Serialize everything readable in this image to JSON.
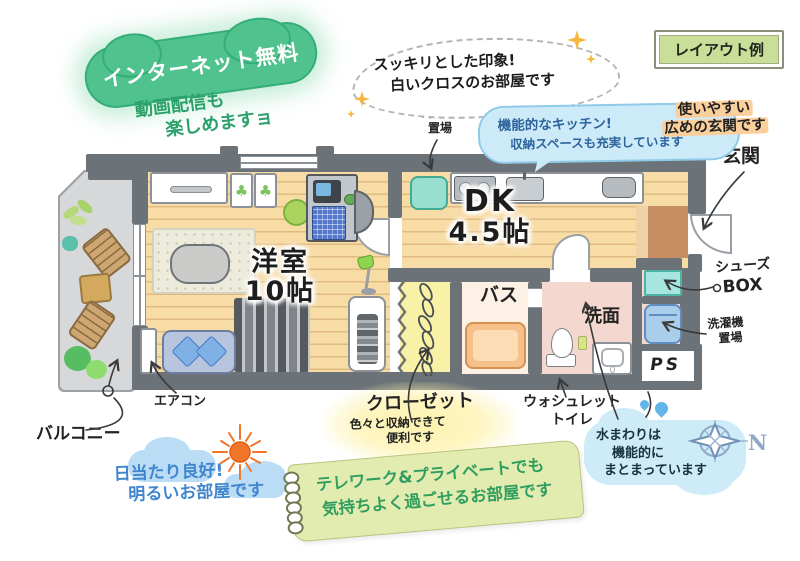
{
  "badge": "レイアウト例",
  "rooms": {
    "living_name": "洋室",
    "living_size": "10帖",
    "dk_name": "DK",
    "dk_size": "4.5帖",
    "bath": "バス",
    "washroom": "洗面",
    "entrance": "玄関",
    "balcony": "バルコニー",
    "ps": "PS"
  },
  "labels": {
    "fridge_l1": "冷蔵庫",
    "fridge_l2": "置場",
    "aircon": "エアコン",
    "shoes_l1": "シューズ",
    "shoes_l2": "BOX",
    "washer_l1": "洗濯機",
    "washer_l2": "置場",
    "toilet_l1": "ウォシュレット",
    "toilet_l2": "トイレ",
    "compass_n": "N"
  },
  "callouts": {
    "internet_title": "インターネット無料",
    "internet_sub_l1": "動画配信も",
    "internet_sub_l2": "楽しめますョ",
    "impression_l1": "スッキリとした印象!",
    "impression_l2": "白いクロスのお部屋です",
    "kitchen_l1": "機能的なキッチン!",
    "kitchen_l2": "収納スペースも充実しています",
    "entrance_l1": "使いやすい",
    "entrance_l2": "広めの玄関です",
    "closet_title": "クローゼット",
    "closet_l1": "色々と収納できて",
    "closet_l2": "便利です",
    "water_l1": "水まわりは",
    "water_l2": "機能的に",
    "water_l3": "まとまっています",
    "sun_l1": "日当たり良好!",
    "sun_l2": "明るいお部屋です",
    "telework_l1": "テレワーク&プライベートでも",
    "telework_l2": "気持ちよく過ごせるお部屋です"
  },
  "colors": {
    "wall": "#6b7378",
    "wood_floor": "#f8dca6",
    "balcony_floor": "#d7d8da",
    "entrance_floor": "#c78f63",
    "closet": "#f8f1a6",
    "bathtub": "#f5c08a",
    "washroom_floor": "#f4d8cf",
    "shoes_box": "#a7e6de",
    "washer": "#a9cdea",
    "fridge_space": "#99dfd0",
    "internet_green": "#4fc28e",
    "bubble_blue": "#cdeaf8",
    "highlight_orange": "#fbcf9b",
    "notepad_green": "#e3ecb0",
    "handwriting_green": "#2aa06a",
    "sun_text_blue": "#3f86cf",
    "sun_orange": "#f2762a",
    "compass_blue": "#8fa9c9",
    "badge_green": "#c9df99"
  }
}
